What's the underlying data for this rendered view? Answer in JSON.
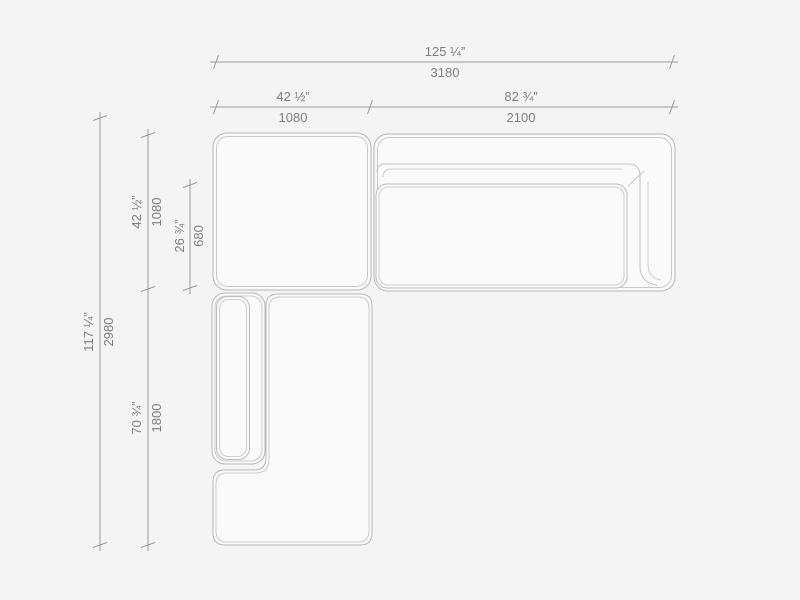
{
  "page": {
    "background": "#f4f4f5"
  },
  "drawing": {
    "title": "Sectional sofa plan view with dimensions",
    "units": "inches over millimetres",
    "colors": {
      "background": "#f4f4f5",
      "module_fill": "#fafafa",
      "module_outline": "#b6b6b6",
      "module_inner_line": "#c9c9c9",
      "dimension_line": "#9a9a9a",
      "label_text": "#7e7e7e"
    },
    "horizontal": {
      "overall": {
        "inches": "125 ¼”",
        "mm": "3180"
      },
      "left_module": {
        "inches": "42 ½”",
        "mm": "1080"
      },
      "right_module": {
        "inches": "82 ¾”",
        "mm": "2100"
      }
    },
    "vertical": {
      "overall": {
        "inches": "117 ¼”",
        "mm": "2980"
      },
      "top_module": {
        "inches": "42 ½”",
        "mm": "1080"
      },
      "seat_depth": {
        "inches": "26 ¾”",
        "mm": "680"
      },
      "chaise_module": {
        "inches": "70 ¾”",
        "mm": "1800"
      }
    }
  }
}
